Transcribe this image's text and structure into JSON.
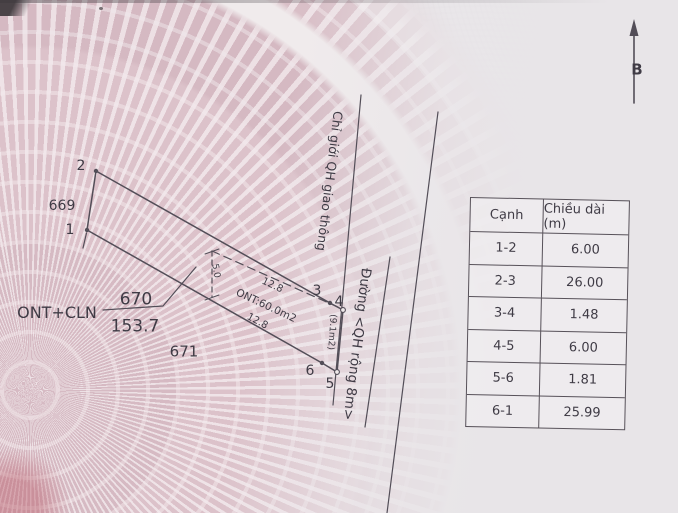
{
  "north_arrow": {
    "label": "B"
  },
  "diagram": {
    "point_labels": {
      "p1": "1",
      "p2": "2",
      "p3": "3",
      "p4": "4",
      "p5": "5",
      "p6": "6"
    },
    "parcel_main": {
      "number": "670",
      "area": "153.7",
      "land_use": "ONT+CLN"
    },
    "parcel_left": "669",
    "parcel_bottom": "671",
    "planning_boundary_label": "Chỉ giới QH giao thông",
    "road_label": "Đường <QH rộng 8m>",
    "ont_area_label": "ONT:60.0m2",
    "strip_area_label": "(9.1m2)",
    "dim_top": "12.8",
    "dim_bottom": "12.8",
    "dim_side": "5.0"
  },
  "table": {
    "col_edge": "Cạnh",
    "col_length": "Chiều dài (m)",
    "rows": [
      {
        "edge": "1-2",
        "length": "6.00"
      },
      {
        "edge": "2-3",
        "length": "26.00"
      },
      {
        "edge": "3-4",
        "length": "1.48"
      },
      {
        "edge": "4-5",
        "length": "6.00"
      },
      {
        "edge": "5-6",
        "length": "1.81"
      },
      {
        "edge": "6-1",
        "length": "25.99"
      }
    ]
  },
  "colors": {
    "line": "#534e58",
    "text": "#3f3b45",
    "paper": "#e9e6e9",
    "pattern_pink": "#d8bdc5"
  }
}
